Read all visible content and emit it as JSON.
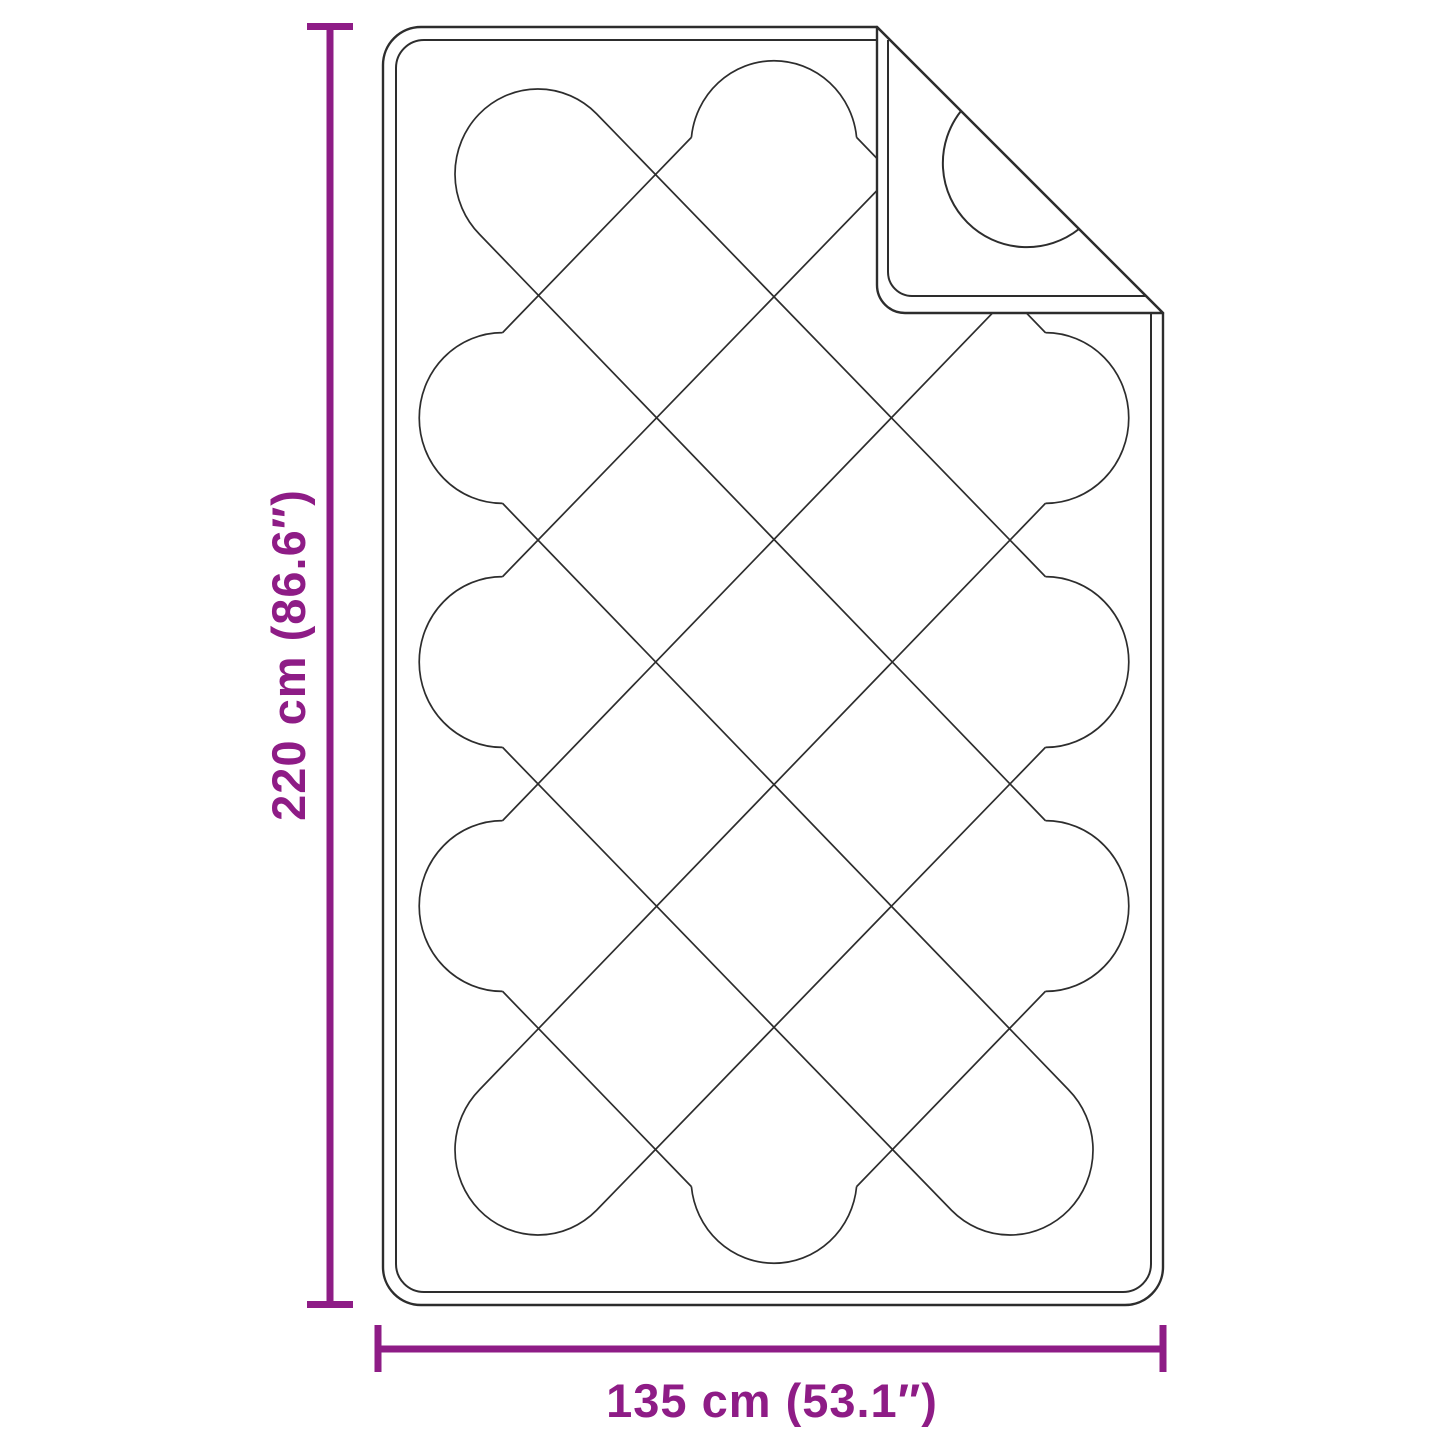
{
  "diagram": {
    "title": "quilted-blanket-dimension-diagram",
    "product": "quilted blanket with folded corner",
    "height_label": "220 cm (86.6″)",
    "width_label": "135 cm (53.1″)",
    "height_value_cm": 220,
    "height_value_inch": 86.6,
    "width_value_cm": 135,
    "width_value_inch": 53.1,
    "accent_color": "#8e1c86",
    "line_color": "#2d2d2d",
    "background_color": "#ffffff",
    "quilt_pattern": "diamond-serpentine",
    "quilt_columns": 3,
    "quilt_rows": 5
  }
}
